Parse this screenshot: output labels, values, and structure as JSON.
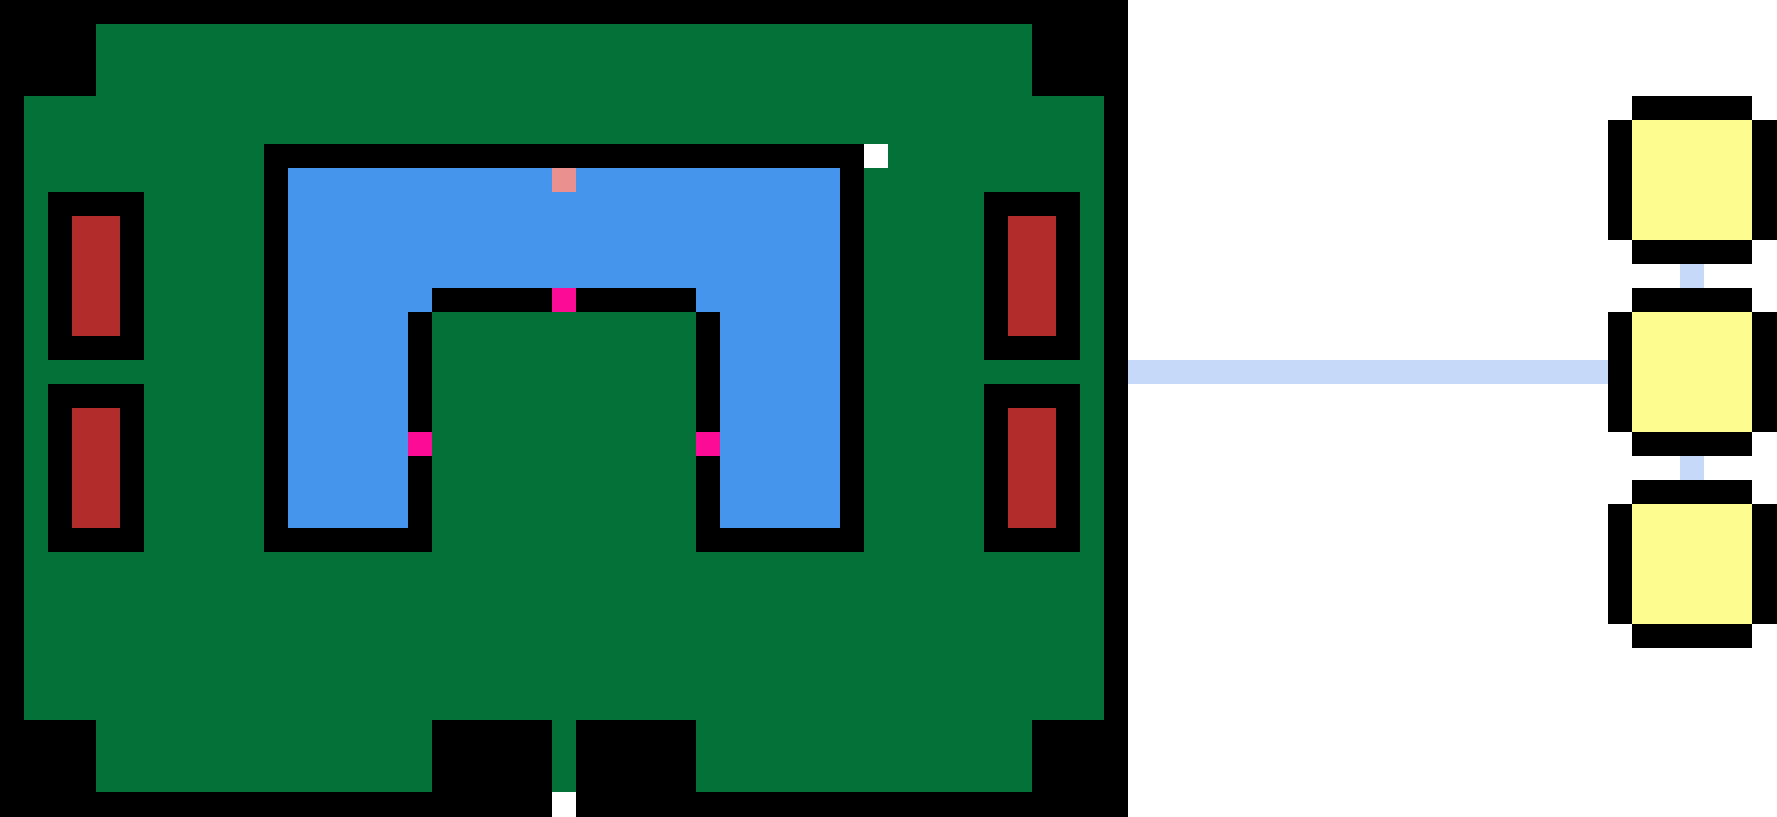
{
  "canvas": {
    "width": 1777,
    "height": 817
  },
  "grid": {
    "cell_size_px": 24,
    "cols": 74,
    "rows": 34
  },
  "palette": {
    "black": "#000000",
    "white": "#ffffff",
    "green": "#047138",
    "blue": "#4595ec",
    "dark_red": "#b22c2c",
    "magenta": "#fb0b96",
    "salmon": "#ea908e",
    "yellow": "#fdfd8f",
    "pale_blue": "#c6d9f8"
  },
  "scene": {
    "description": "Pixel-art game view: green fortress room with U-shaped blue moat, red doors and pink markers on the left; room-graph minimap with three yellow rooms linked by pale blue corridors on the right.",
    "rects": [
      {
        "name": "left-panel-background",
        "x": 0,
        "y": 0,
        "w": 1128,
        "h": 817,
        "color": "black",
        "interactable": false
      },
      {
        "name": "right-panel-background",
        "x": 1128,
        "y": 0,
        "w": 649,
        "h": 817,
        "color": "white",
        "interactable": false
      },
      {
        "name": "fortress-body-tall",
        "x": 96,
        "y": 24,
        "w": 936,
        "h": 768,
        "color": "green",
        "interactable": false
      },
      {
        "name": "fortress-body-wide",
        "x": 24,
        "y": 96,
        "w": 1080,
        "h": 624,
        "color": "green",
        "interactable": false
      },
      {
        "name": "moat-outer-wall",
        "x": 264,
        "y": 144,
        "w": 600,
        "h": 408,
        "color": "black",
        "interactable": false
      },
      {
        "name": "moat-water",
        "x": 288,
        "y": 168,
        "w": 552,
        "h": 360,
        "color": "blue",
        "interactable": false
      },
      {
        "name": "island-inner-wall",
        "x": 408,
        "y": 288,
        "w": 312,
        "h": 264,
        "color": "black",
        "interactable": false
      },
      {
        "name": "moat-corner-left",
        "x": 408,
        "y": 288,
        "w": 24,
        "h": 24,
        "color": "blue",
        "interactable": false
      },
      {
        "name": "moat-corner-right",
        "x": 696,
        "y": 288,
        "w": 24,
        "h": 24,
        "color": "blue",
        "interactable": false
      },
      {
        "name": "center-island",
        "x": 432,
        "y": 312,
        "w": 264,
        "h": 240,
        "color": "green",
        "interactable": false
      },
      {
        "name": "salmon-marker",
        "x": 552,
        "y": 168,
        "w": 24,
        "h": 24,
        "color": "salmon",
        "interactable": true
      },
      {
        "name": "pink-marker-top",
        "x": 552,
        "y": 288,
        "w": 24,
        "h": 24,
        "color": "magenta",
        "interactable": true
      },
      {
        "name": "pink-marker-left",
        "x": 408,
        "y": 432,
        "w": 24,
        "h": 24,
        "color": "magenta",
        "interactable": true
      },
      {
        "name": "pink-marker-right",
        "x": 696,
        "y": 432,
        "w": 24,
        "h": 24,
        "color": "magenta",
        "interactable": true
      },
      {
        "name": "white-door-top-right",
        "x": 864,
        "y": 144,
        "w": 24,
        "h": 24,
        "color": "white",
        "interactable": true
      },
      {
        "name": "door-frame-left-upper",
        "x": 48,
        "y": 192,
        "w": 96,
        "h": 168,
        "color": "black",
        "interactable": false
      },
      {
        "name": "red-door-left-upper",
        "x": 72,
        "y": 216,
        "w": 48,
        "h": 120,
        "color": "dark_red",
        "interactable": true
      },
      {
        "name": "door-frame-left-lower",
        "x": 48,
        "y": 384,
        "w": 96,
        "h": 168,
        "color": "black",
        "interactable": false
      },
      {
        "name": "red-door-left-lower",
        "x": 72,
        "y": 408,
        "w": 48,
        "h": 120,
        "color": "dark_red",
        "interactable": true
      },
      {
        "name": "door-frame-right-upper",
        "x": 984,
        "y": 192,
        "w": 96,
        "h": 168,
        "color": "black",
        "interactable": false
      },
      {
        "name": "red-door-right-upper",
        "x": 1008,
        "y": 216,
        "w": 48,
        "h": 120,
        "color": "dark_red",
        "interactable": true
      },
      {
        "name": "door-frame-right-lower",
        "x": 984,
        "y": 384,
        "w": 96,
        "h": 168,
        "color": "black",
        "interactable": false
      },
      {
        "name": "red-door-right-lower",
        "x": 1008,
        "y": 408,
        "w": 48,
        "h": 120,
        "color": "dark_red",
        "interactable": true
      },
      {
        "name": "bottom-notch-left",
        "x": 432,
        "y": 720,
        "w": 120,
        "h": 72,
        "color": "black",
        "interactable": false
      },
      {
        "name": "bottom-notch-right",
        "x": 576,
        "y": 720,
        "w": 120,
        "h": 72,
        "color": "black",
        "interactable": false
      },
      {
        "name": "white-door-bottom",
        "x": 552,
        "y": 792,
        "w": 24,
        "h": 25,
        "color": "white",
        "interactable": true
      },
      {
        "name": "map-corridor-horizontal",
        "x": 1128,
        "y": 360,
        "w": 480,
        "h": 24,
        "color": "pale_blue",
        "interactable": false
      },
      {
        "name": "room1-border-vertical",
        "x": 1632,
        "y": 96,
        "w": 120,
        "h": 168,
        "color": "black",
        "interactable": false
      },
      {
        "name": "room1-border-horizontal",
        "x": 1608,
        "y": 120,
        "w": 169,
        "h": 120,
        "color": "black",
        "interactable": false
      },
      {
        "name": "room1-fill",
        "x": 1632,
        "y": 120,
        "w": 120,
        "h": 120,
        "color": "yellow",
        "interactable": true
      },
      {
        "name": "map-corridor-rooms-1-2",
        "x": 1680,
        "y": 264,
        "w": 24,
        "h": 24,
        "color": "pale_blue",
        "interactable": false
      },
      {
        "name": "room2-border-vertical",
        "x": 1632,
        "y": 288,
        "w": 120,
        "h": 168,
        "color": "black",
        "interactable": false
      },
      {
        "name": "room2-border-horizontal",
        "x": 1608,
        "y": 312,
        "w": 169,
        "h": 120,
        "color": "black",
        "interactable": false
      },
      {
        "name": "room2-fill",
        "x": 1632,
        "y": 312,
        "w": 120,
        "h": 120,
        "color": "yellow",
        "interactable": true
      },
      {
        "name": "map-corridor-rooms-2-3",
        "x": 1680,
        "y": 456,
        "w": 24,
        "h": 24,
        "color": "pale_blue",
        "interactable": false
      },
      {
        "name": "room3-border-vertical",
        "x": 1632,
        "y": 480,
        "w": 120,
        "h": 168,
        "color": "black",
        "interactable": false
      },
      {
        "name": "room3-border-horizontal",
        "x": 1608,
        "y": 504,
        "w": 169,
        "h": 120,
        "color": "black",
        "interactable": false
      },
      {
        "name": "room3-fill",
        "x": 1632,
        "y": 504,
        "w": 120,
        "h": 120,
        "color": "yellow",
        "interactable": true
      }
    ]
  }
}
